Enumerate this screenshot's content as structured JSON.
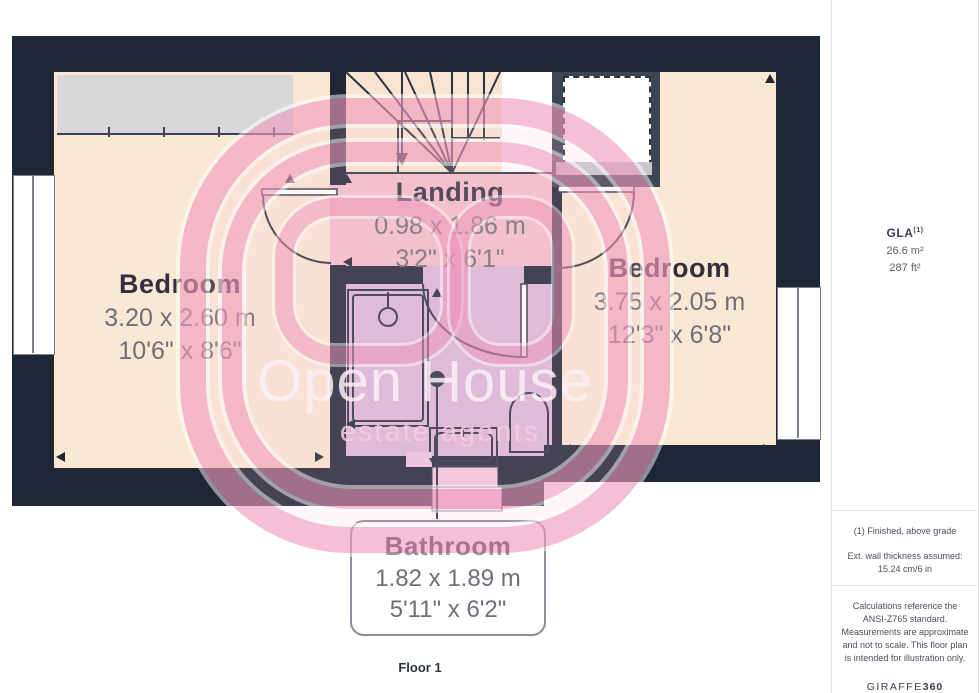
{
  "rooms": {
    "landing": {
      "name": "Landing",
      "metric": "0.98 x 1.86 m",
      "imperial": "3'2\" x 6'1\""
    },
    "bedroom_left": {
      "name": "Bedroom",
      "metric": "3.20 x 2.60 m",
      "imperial": "10'6\" x 8'6\""
    },
    "bedroom_right": {
      "name": "Bedroom",
      "metric": "3.75 x 2.05 m",
      "imperial": "12'3\" x 6'8\""
    },
    "bathroom": {
      "name": "Bathroom",
      "metric": "1.82 x 1.89 m",
      "imperial": "5'11\" x 6'2\""
    }
  },
  "floor_label": "Floor 1",
  "watermark": {
    "title": "Open House",
    "subtitle": "estate agents"
  },
  "sidebar": {
    "gla_label": "GLA",
    "gla_footnote_marker": "(1)",
    "area_metric": "26.6 m²",
    "area_imperial": "287 ft²",
    "footnote": "(1) Finished, above grade",
    "wall_note": "Ext. wall thickness assumed: 15.24 cm/6 in",
    "disclaimer": "Calculations reference the ANSI-Z765 standard. Measurements are approximate and not to scale. This floor plan is intended for illustration only.",
    "brand_name": "GIRAFFE",
    "brand_suffix": "360"
  },
  "colors": {
    "wall": "#1f2736",
    "bedroom_floor": "#fbe8d4",
    "landing_floor": "#f3bfcb",
    "bathroom_floor": "#dcb9d8",
    "wardrobe_gray": "#d8d8db",
    "watermark_pink": "#ee94ba",
    "line": "#2b3240"
  },
  "icons": {
    "stairs_direction_arrow": "down-triangle",
    "dimension_marker": "filled-triangle"
  }
}
